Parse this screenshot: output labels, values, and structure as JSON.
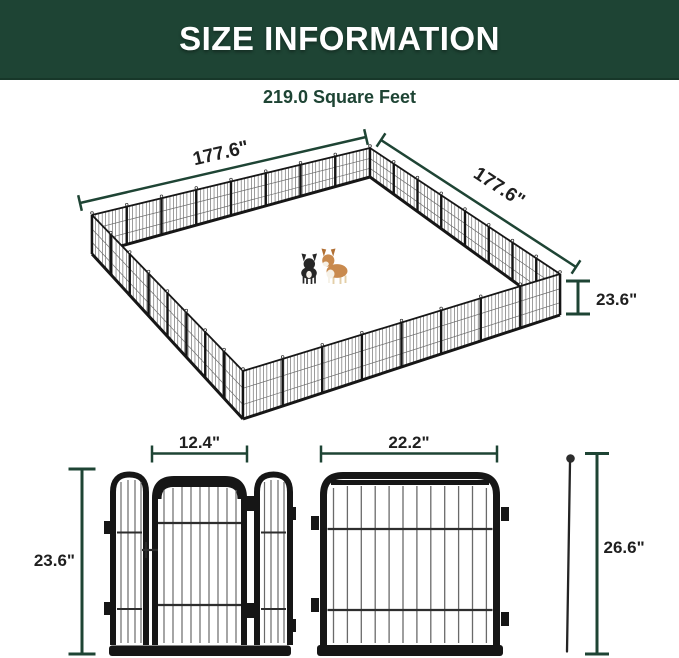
{
  "header": {
    "title": "SIZE INFORMATION"
  },
  "subtitle": "219.0 Square Feet",
  "pen": {
    "width_label": "177.6\"",
    "depth_label": "177.6\"",
    "height_label": "23.6\""
  },
  "door_panel": {
    "width_label": "12.4\"",
    "height_label": "23.6\""
  },
  "large_panel": {
    "width_label": "22.2\""
  },
  "stake": {
    "height_label": "26.6\""
  },
  "colors": {
    "banner_green": "#1e4434",
    "dimension_line_green": "#1e4434",
    "dimension_text": "#1f1f1f",
    "frame_black": "#161616",
    "wire_gray": "#6a6a6a",
    "dog_black": "#262626",
    "dog_tan": "#c98a4e"
  }
}
